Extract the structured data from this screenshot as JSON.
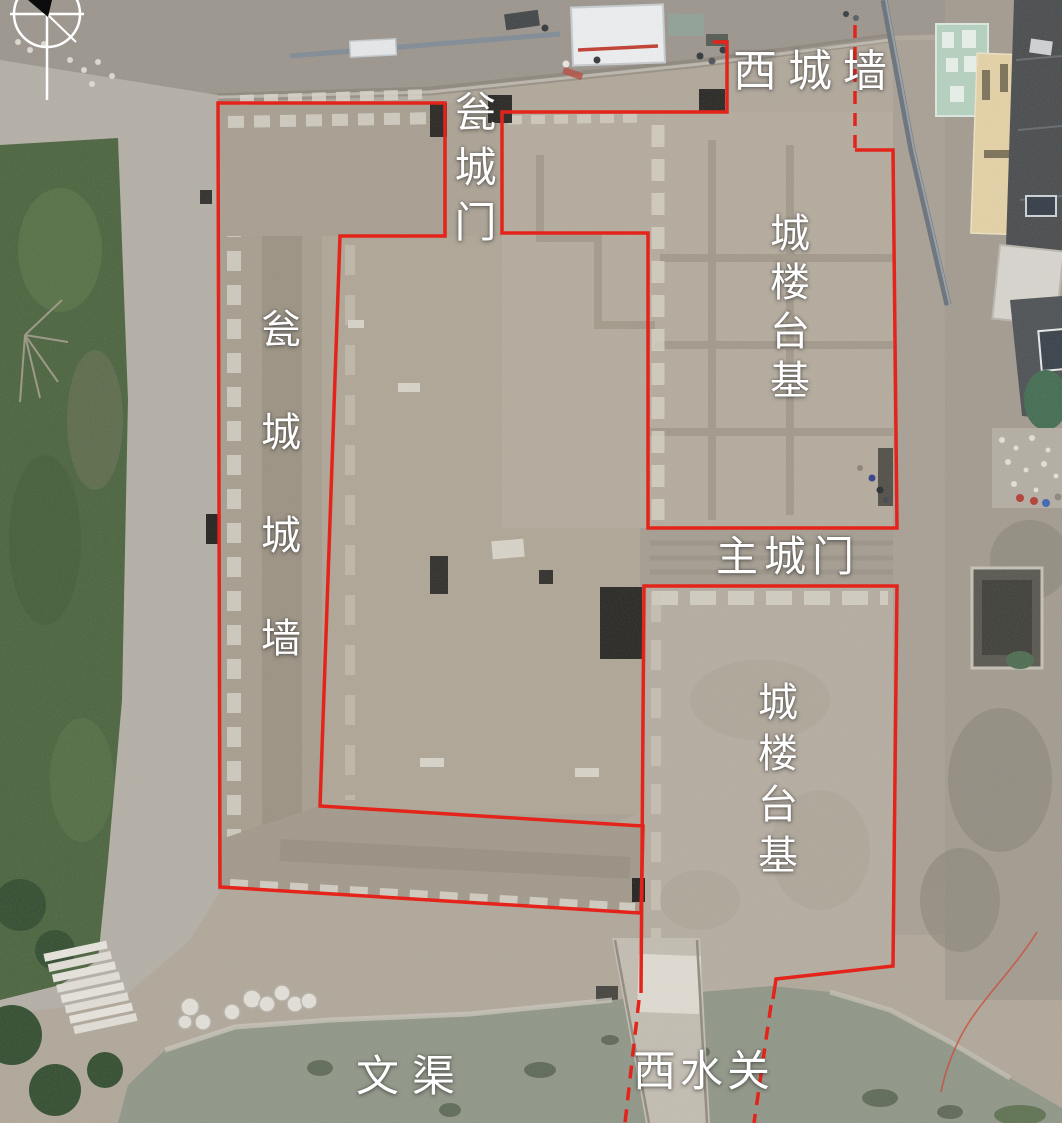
{
  "annotation": {
    "line_color": "#e4241a",
    "label_color": "#ffffff"
  },
  "labels": {
    "west_city_wall": {
      "text": "西城墙"
    },
    "barbican_gate": {
      "text": "瓮城门"
    },
    "gate_tower_platform_north": {
      "text": "城楼台基"
    },
    "barbican_city_wall": {
      "text": "瓮城城墙"
    },
    "main_city_gate": {
      "text": "主城门"
    },
    "gate_tower_platform_south": {
      "text": "城楼台基"
    },
    "wen_canal": {
      "text": "文渠"
    },
    "west_water_gate": {
      "text": "西水关"
    }
  },
  "icons": {
    "north_arrow": "north-arrow-compass"
  }
}
